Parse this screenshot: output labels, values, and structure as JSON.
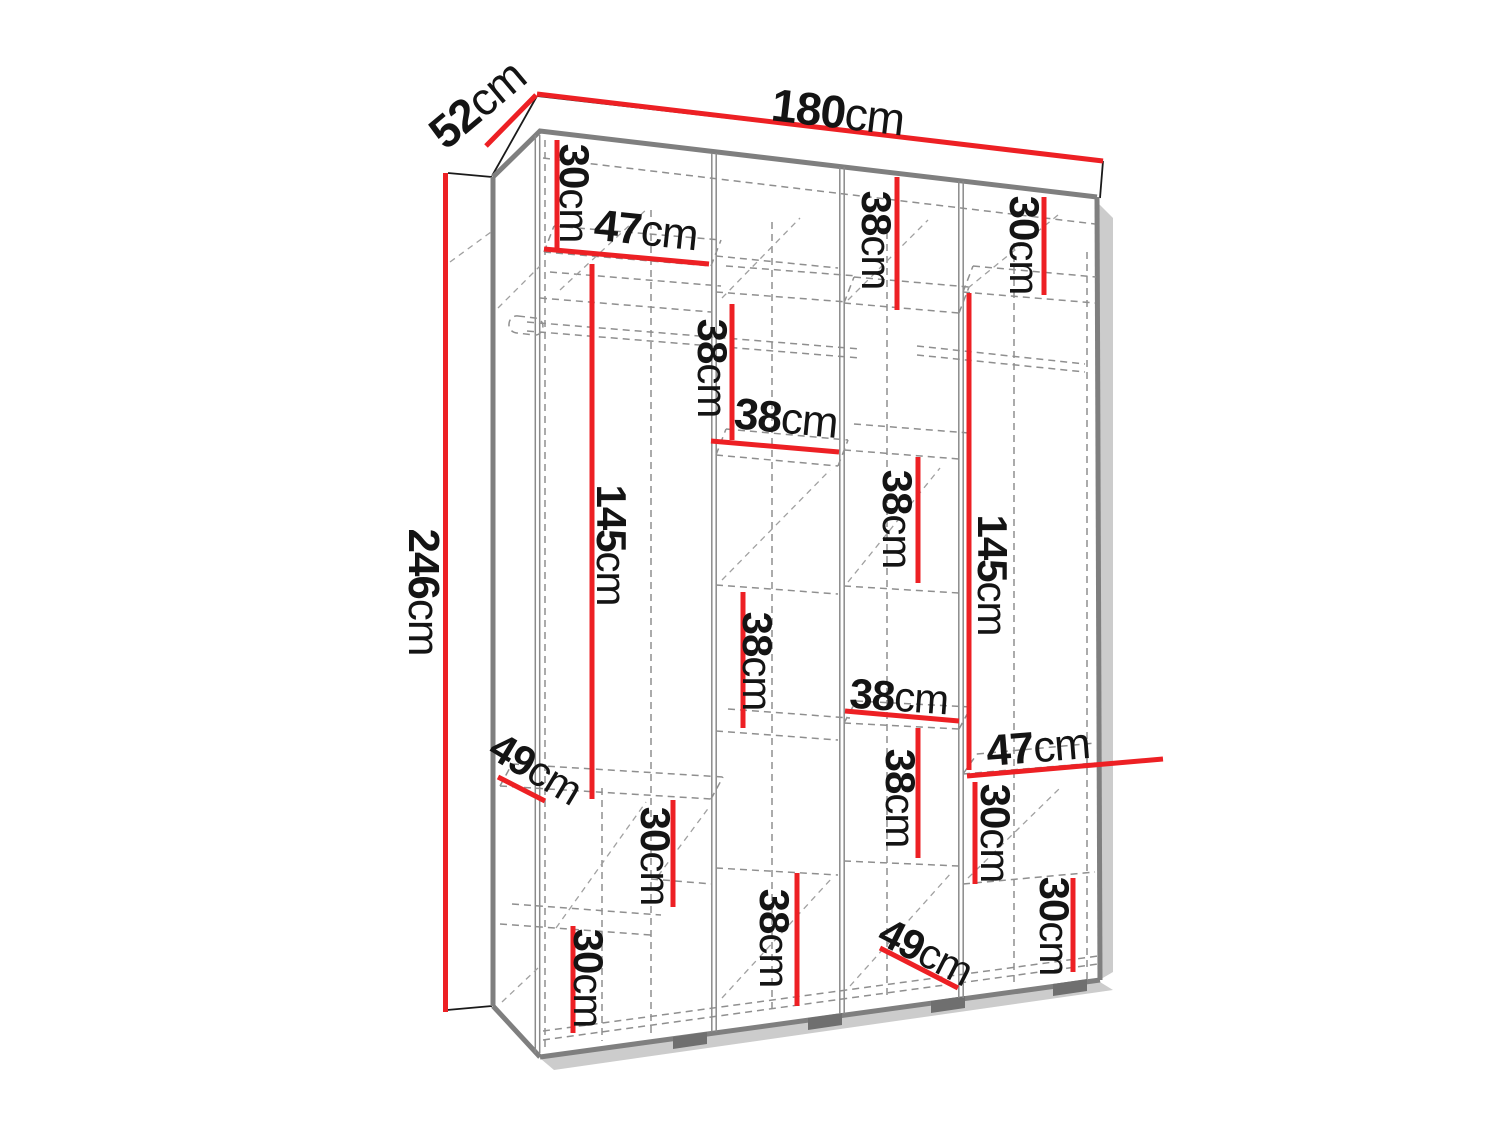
{
  "diagram": {
    "type": "furniture-dimension-diagram",
    "subject": "four-section wardrobe interior with shelves and hanging rods",
    "unit": "cm",
    "colors": {
      "dimension_red": "#ed2024",
      "edge_grey": "#7f7f7f",
      "dash_grey": "#8f8f8f",
      "text_black": "#141414"
    },
    "overall_dimensions": {
      "width_cm": 180,
      "depth_cm": 52,
      "height_cm": 246
    },
    "labels": {
      "w180": {
        "num": "180",
        "unit": "cm"
      },
      "d52": {
        "num": "52",
        "unit": "cm"
      },
      "h246": {
        "num": "246",
        "unit": "cm"
      },
      "t30a": {
        "num": "30",
        "unit": "cm"
      },
      "t47a": {
        "num": "47",
        "unit": "cm"
      },
      "t145a": {
        "num": "145",
        "unit": "cm"
      },
      "t49a": {
        "num": "49",
        "unit": "cm"
      },
      "t30b": {
        "num": "30",
        "unit": "cm"
      },
      "t30c": {
        "num": "30",
        "unit": "cm"
      },
      "t38a": {
        "num": "38",
        "unit": "cm"
      },
      "t38b": {
        "num": "38",
        "unit": "cm"
      },
      "t38c": {
        "num": "38",
        "unit": "cm"
      },
      "t38d": {
        "num": "38",
        "unit": "cm"
      },
      "t38e": {
        "num": "38",
        "unit": "cm"
      },
      "t38f": {
        "num": "38",
        "unit": "cm"
      },
      "t38g": {
        "num": "38",
        "unit": "cm"
      },
      "t38h": {
        "num": "38",
        "unit": "cm"
      },
      "t49b": {
        "num": "49",
        "unit": "cm"
      },
      "t145b": {
        "num": "145",
        "unit": "cm"
      },
      "t30d": {
        "num": "30",
        "unit": "cm"
      },
      "t47b": {
        "num": "47",
        "unit": "cm"
      },
      "t30e": {
        "num": "30",
        "unit": "cm"
      },
      "t30f": {
        "num": "30",
        "unit": "cm"
      }
    }
  }
}
